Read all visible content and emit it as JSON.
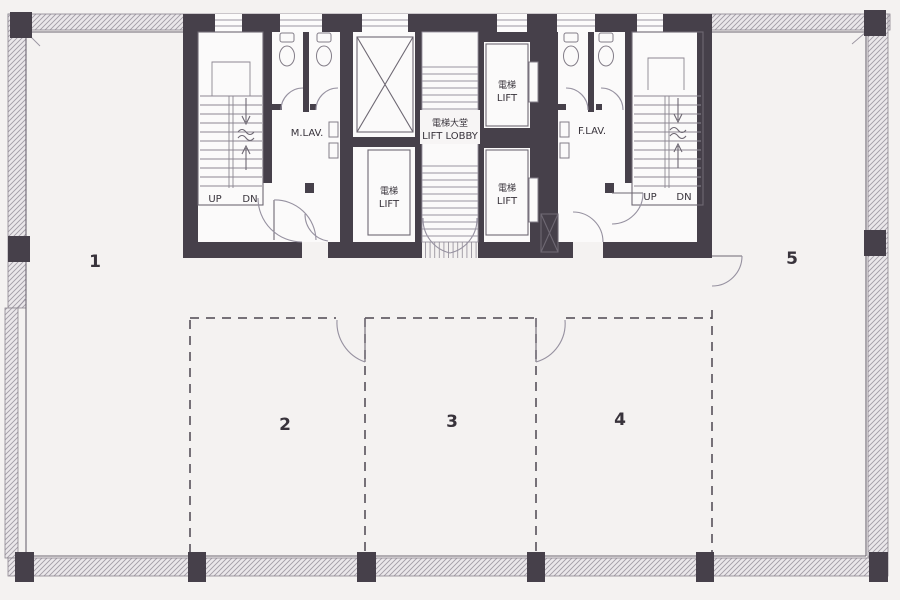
{
  "units": [
    {
      "name": "unit-1",
      "label": "1"
    },
    {
      "name": "unit-2",
      "label": "2"
    },
    {
      "name": "unit-3",
      "label": "3"
    },
    {
      "name": "unit-4",
      "label": "4"
    },
    {
      "name": "unit-5",
      "label": "5"
    }
  ],
  "core": {
    "stair_left": {
      "up": "UP",
      "down": "DN"
    },
    "stair_right": {
      "up": "UP",
      "down": "DN"
    },
    "mens_lav_label": "M.LAV.",
    "womens_lav_label": "F.LAV.",
    "lift_lobby": {
      "label_zh": "電梯大堂",
      "label_en": "LIFT LOBBY"
    },
    "lift_left": {
      "label_zh": "電梯",
      "label_en": "LIFT"
    },
    "lift_right_top": {
      "label_zh": "電梯",
      "label_en": "LIFT"
    },
    "lift_right_bottom": {
      "label_zh": "電梯",
      "label_en": "LIFT"
    }
  },
  "colors": {
    "wall_dark": "#46404a",
    "background": "#f4f2f1",
    "line": "#6e6873",
    "dashed_partition": "#4c4650",
    "text": "#38333b"
  }
}
